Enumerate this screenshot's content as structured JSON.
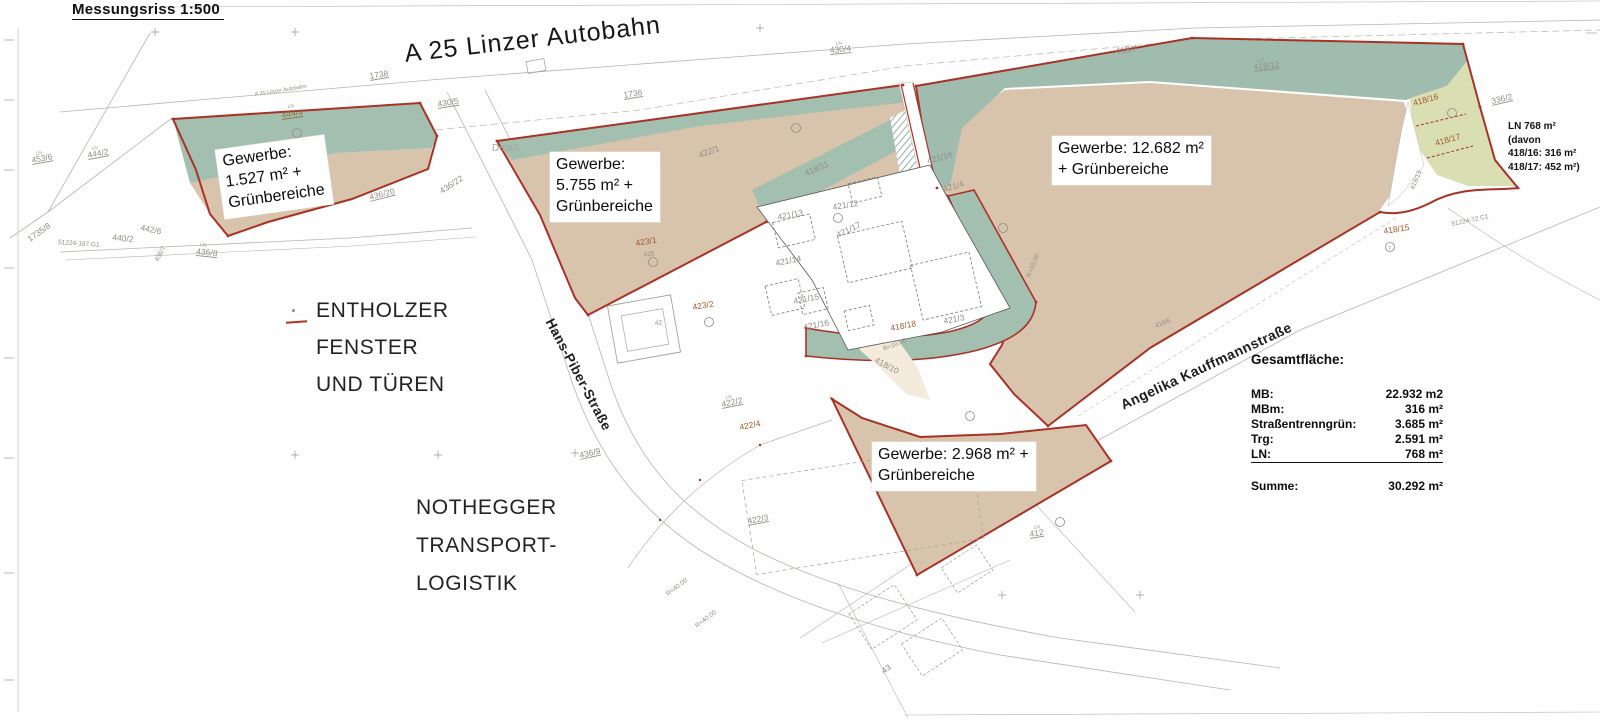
{
  "title": "Messungsriss  1:500",
  "map": {
    "autobahn": "A 25 Linzer Autobahn",
    "autobahn_small": "A 25 Linzer Autobahn",
    "street_hans_piber": "Hans-Piber-Straße",
    "street_angelika": "Angelika Kauffmannstraße",
    "detail": "Detail:",
    "ln_mark": "LN"
  },
  "annotations": {
    "entholzer": {
      "line1": "ENTHOLZER",
      "line2": "FENSTER",
      "line3": "UND TÜREN"
    },
    "nothegger": {
      "line1": "NOTHEGGER",
      "line2": "TRANSPORT-",
      "line3": "LOGISTIK"
    }
  },
  "gewerbe_labels": [
    {
      "line1": "Gewerbe:",
      "line2": "1.527 m² +",
      "line3": "Grünbereiche"
    },
    {
      "line1": "Gewerbe:",
      "line2": "5.755 m² +",
      "line3": "Grünbereiche"
    },
    {
      "line1": "Gewerbe: 12.682 m²",
      "line2": "+ Grünbereiche"
    },
    {
      "line1": "Gewerbe: 2.968 m² +",
      "line2": "Grünbereiche"
    }
  ],
  "ln_note": {
    "line1": "LN 768 m²",
    "line2": "(davon",
    "line3": "418/16: 316 m²",
    "line4": "418/17: 452 m²)"
  },
  "summary": {
    "heading": "Gesamtfläche:",
    "rows": [
      {
        "label": "MB:",
        "value": "22.932 m2"
      },
      {
        "label": "MBm:",
        "value": "316 m²"
      },
      {
        "label": "Straßentrenngrün:",
        "value": "3.685 m²"
      },
      {
        "label": "Trg:",
        "value": "2.591 m²"
      },
      {
        "label": "LN:",
        "value": "768 m²"
      }
    ],
    "total_label": "Summe:",
    "total_value": "30.292 m²"
  },
  "parcels": [
    {
      "text": "444/4"
    },
    {
      "text": "444/2"
    },
    {
      "text": "453/6"
    },
    {
      "text": "1735/8"
    },
    {
      "text": "51224-187 G1"
    },
    {
      "text": "440/2"
    },
    {
      "text": "442/6"
    },
    {
      "text": "436/7"
    },
    {
      "text": "436/8"
    },
    {
      "text": "436/20"
    },
    {
      "text": "436/22"
    },
    {
      "text": "436/9"
    },
    {
      "text": "1738"
    },
    {
      "text": "430/5"
    },
    {
      "text": "430/4"
    },
    {
      "text": "1736"
    },
    {
      "text": "422/1"
    },
    {
      "text": "423/1"
    },
    {
      "text": "425"
    },
    {
      "text": "423/2"
    },
    {
      "text": "42"
    },
    {
      "text": "421/13"
    },
    {
      "text": "421/12"
    },
    {
      "text": "421/18"
    },
    {
      "text": "421/4"
    },
    {
      "text": "421/17"
    },
    {
      "text": "421/14"
    },
    {
      "text": "421/15"
    },
    {
      "text": "421/16"
    },
    {
      "text": "421/3"
    },
    {
      "text": "418/11"
    },
    {
      "text": "418/18"
    },
    {
      "text": "418/10"
    },
    {
      "text": "418/12"
    },
    {
      "text": "418/7"
    },
    {
      "text": "418/16"
    },
    {
      "text": "418/17"
    },
    {
      "text": "418/13"
    },
    {
      "text": "336/2"
    },
    {
      "text": "51224-72 C1"
    },
    {
      "text": "418/15"
    },
    {
      "text": "7"
    },
    {
      "text": "418/6"
    },
    {
      "text": "422/2"
    },
    {
      "text": "422/4"
    },
    {
      "text": "422/3"
    },
    {
      "text": "R=40.00"
    },
    {
      "text": "R=40.00"
    },
    {
      "text": "R=10.00"
    },
    {
      "text": "R=10.00"
    },
    {
      "text": "412"
    },
    {
      "text": "43"
    }
  ],
  "colors": {
    "parcel_tan": "#d8c4ac",
    "green_strip": "#a2bfb0",
    "light_green_ln": "#dadfb3",
    "cream_road": "#f4ebdc",
    "boundary_red": "#a93226",
    "label_red_brown": "#a2582f",
    "label_gray": "#918e86"
  }
}
